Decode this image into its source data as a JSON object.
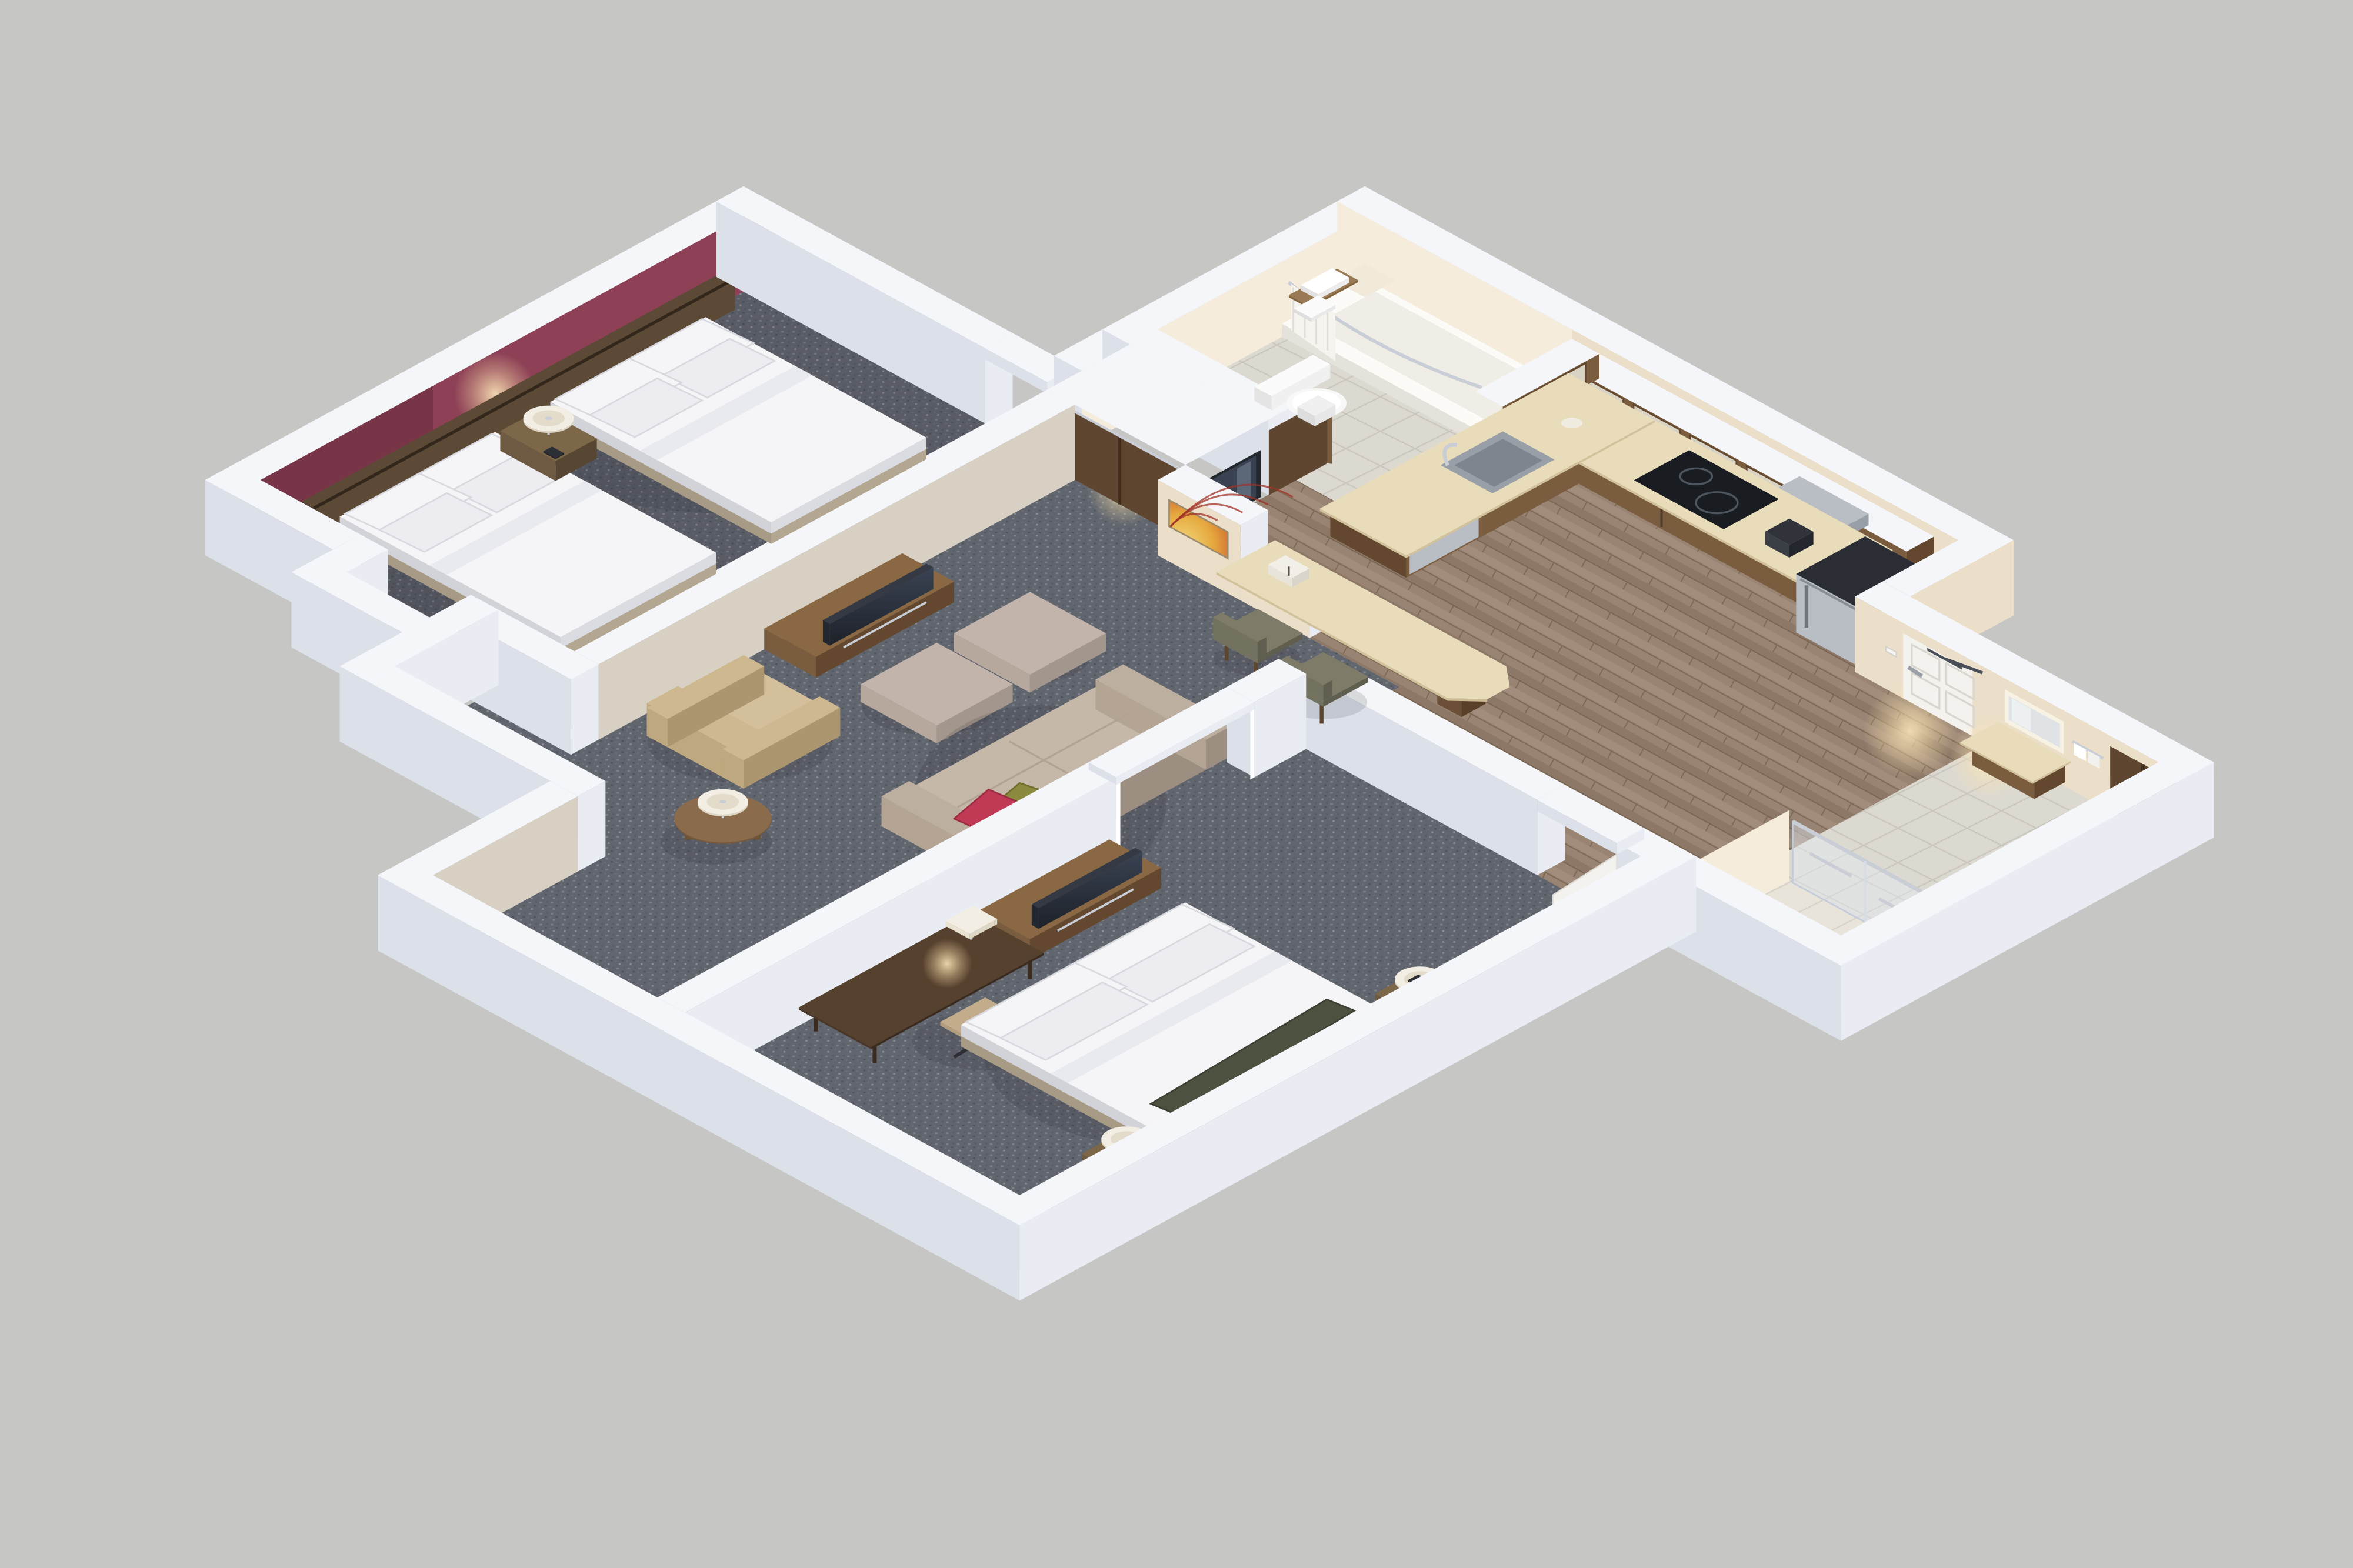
{
  "scene": {
    "type": "isometric-3d-floor-plan",
    "description": "Overhead 3D cutaway rendering of a two-bedroom hotel suite with white cut walls on a gray background",
    "rooms": [
      {
        "id": "bedroom-1",
        "label": "Bedroom with two queen beds",
        "features": [
          "maroon accent wall",
          "dark wood headboard panel",
          "two queen beds with white bedding",
          "shared nightstand with table lamp and phone",
          "flat-screen TV on dark media stand",
          "sliding-door closet",
          "beverage-cooler niche"
        ]
      },
      {
        "id": "bathroom-1",
        "label": "Bathroom with tub shower",
        "features": [
          "tub with curved chrome rod and white shower curtain",
          "corner shelf",
          "toilet",
          "wood towel shelf with white towels",
          "tile floor"
        ]
      },
      {
        "id": "kitchen",
        "label": "Kitchen",
        "features": [
          "glass-front upper cabinets",
          "built-in microwave",
          "L-shaped beige counter",
          "stainless sink with faucet",
          "black two-burner cooktop",
          "coffee maker",
          "dishwasher",
          "stainless top-freezer refrigerator",
          "plank flooring",
          "breakfast bar with two upholstered stools",
          "brochure stand"
        ]
      },
      {
        "id": "entry",
        "label": "Entry hall",
        "features": [
          "white entry door with overhead closer",
          "light switch",
          "plank flooring"
        ]
      },
      {
        "id": "living-room",
        "label": "Living room",
        "features": [
          "sofa with olive and red accent pillows",
          "two ottomans",
          "tan lounge chair",
          "two round side tables with lamps",
          "wood media credenza with TV",
          "sunburst wall art",
          "carpet"
        ]
      },
      {
        "id": "bedroom-2",
        "label": "Bedroom with king bed",
        "features": [
          "king bed with white bedding and dark accent pillows",
          "dark headboard panel",
          "two nightstands with lamps",
          "wood media credenza with TV",
          "dark wood work desk with task lamp",
          "rolling task chair",
          "cased opening to living room"
        ]
      },
      {
        "id": "bathroom-2",
        "label": "Vanity and walk-in shower",
        "features": [
          "lighted vanity mirror",
          "beige vanity counter",
          "towel bar with towels",
          "dark double-door closet",
          "glass walk-in shower with chrome bars",
          "tile floor"
        ]
      }
    ]
  },
  "palette": {
    "background": "#c6c6c4",
    "wallTop": "#f4f6fa",
    "wallFaceSE": "#e9ecf3",
    "wallFaceSW": "#dce0e9",
    "wallOuterShade": "#d2d6df",
    "innerCream": "#ecdfc9",
    "innerCreamLit": "#f5ecdc",
    "innerGreige": "#d8d1c3",
    "innerShadow": "#bfb7a9",
    "maroon": "#8e4156",
    "maroonShade": "#6f2f41",
    "headboardWood": "#4a3a2b",
    "carpet": "#61656e",
    "woodFloor": "#998474",
    "tile": "#dcd9d1",
    "tileLight": "#e8e4da",
    "cabinetWood": "#7a5c3e",
    "cabinetWoodDark": "#63482f",
    "cabinetGlass": "#d9d3c6",
    "counter": "#e9dcba",
    "counterShade": "#d2c29c",
    "stainless": "#b9bec4",
    "stainlessDark": "#989fa7",
    "applianceBlack": "#22262c",
    "bedding": "#f5f5f7",
    "beddingShade": "#dbdce2",
    "bedBase": "#c6b9a5",
    "nightstand": "#6e5a42",
    "nightstandDark": "#574632",
    "lampShade": "#f3eee3",
    "lampRed": "#a34f5e",
    "chrome": "#c9ced6",
    "sofa": "#b3a494",
    "sofaLight": "#c6b8a8",
    "pillowGreen": "#8b8a3e",
    "pillowRed": "#c13a55",
    "armchair": "#c7b28d",
    "ottoman": "#b6a89d",
    "tableWood": "#8a6b4b",
    "deskWood": "#4a3728",
    "tvBlack": "#23272f",
    "chairSeat": "#c2ac8b",
    "chairDark": "#2f3036",
    "stoolFabric": "#73715f",
    "stoolWood": "#5d452e",
    "doorWhite": "#f3f2ee",
    "doorBrown": "#5f4630",
    "glass": "rgba(228,235,245,0.45)",
    "artDeepRed": "#a03226",
    "glow": "#ffe9bd"
  }
}
